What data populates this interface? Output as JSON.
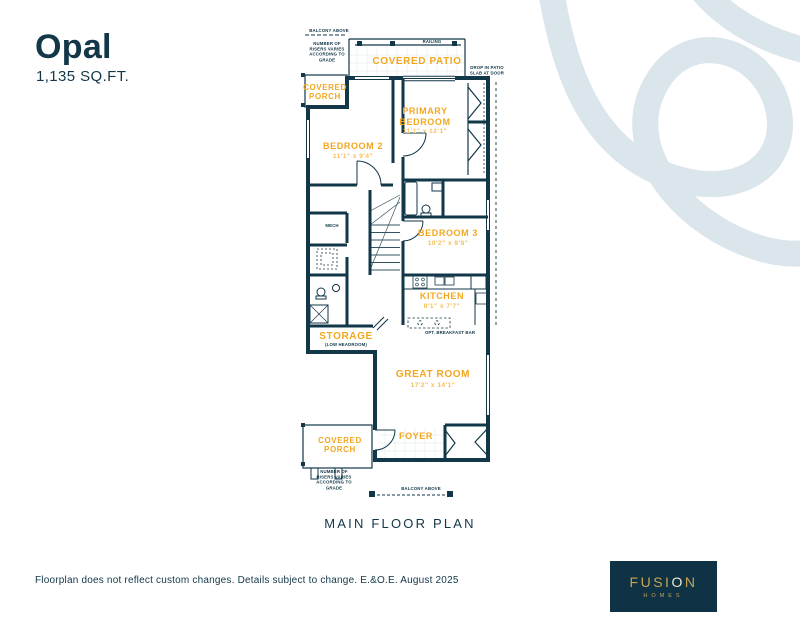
{
  "header": {
    "title": "Opal",
    "sqft": "1,135 SQ.FT."
  },
  "floorplan": {
    "caption": "MAIN FLOOR PLAN",
    "rooms": {
      "covered_patio": {
        "label": "COVERED PATIO"
      },
      "covered_porch_top": {
        "label": "COVERED PORCH"
      },
      "primary_bedroom": {
        "label": "PRIMARY BEDROOM",
        "dims": "11'1\" x 12'1\""
      },
      "bedroom2": {
        "label": "BEDROOM 2",
        "dims": "11'1\" x 9'4\""
      },
      "bedroom3": {
        "label": "BEDROOM 3",
        "dims": "10'2\" x 9'8\""
      },
      "kitchen": {
        "label": "KITCHEN",
        "dims": "8'1\" x 7'7\""
      },
      "storage": {
        "label": "STORAGE",
        "note": "(LOW HEADROOM)"
      },
      "great_room": {
        "label": "GREAT ROOM",
        "dims": "17'2\" x 14'1\""
      },
      "foyer": {
        "label": "FOYER"
      },
      "covered_porch_bottom": {
        "label": "COVERED PORCH"
      }
    },
    "notes": {
      "balcony_above_top": "BALCONY ABOVE",
      "risers_top": "NUMBER OF RISERS VARIES ACCORDING TO GRADE",
      "railing": "RAILING",
      "patio_door": "DROP IN PATIO SLAB AT DOOR",
      "mech": "MECH",
      "opt_breakfast_bar": "OPT. BREAKFAST BAR",
      "risers_bottom": "NUMBER OF RISERS VARIES ACCORDING TO GRADE",
      "balcony_above_bottom": "BALCONY ABOVE"
    }
  },
  "footer": {
    "disclaimer": "Floorplan does not reflect custom changes. Details subject to change. E.&O.E. August 2025"
  },
  "logo": {
    "brand_left": "FUSI",
    "brand_o": "O",
    "brand_right": "N",
    "sub": "HOMES"
  },
  "colors": {
    "navy": "#123748",
    "accent": "#F3A71F",
    "swoosh": "#DBE5EC",
    "gold": "#C9A452"
  }
}
